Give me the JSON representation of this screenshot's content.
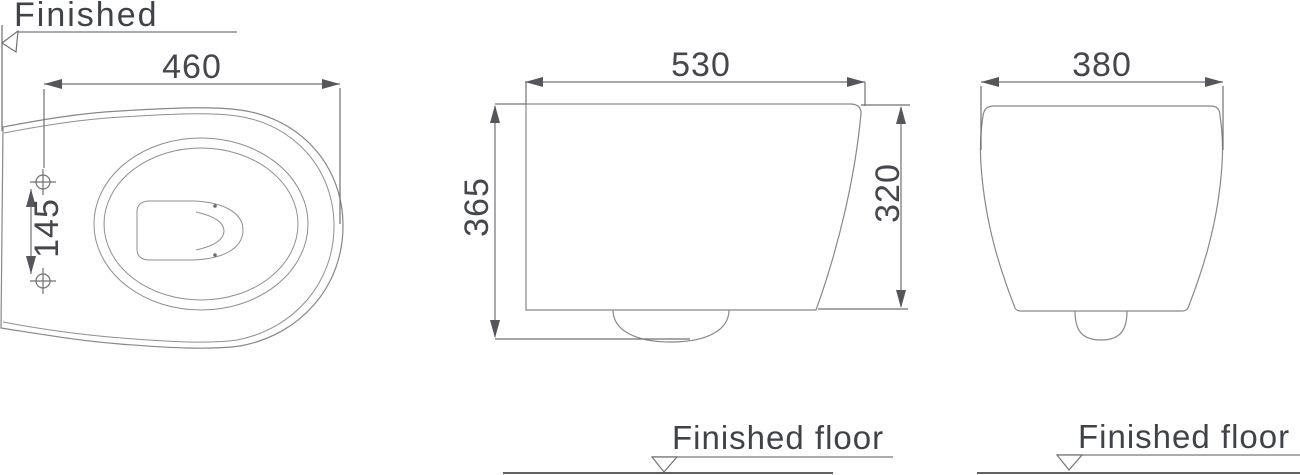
{
  "drawing": {
    "title_context": "wall-hung toilet dimension drawing",
    "labels": {
      "finished_wall": "Finished",
      "finished_floor": "Finished floor"
    },
    "dims": {
      "top_width": "460",
      "hole_spacing": "145",
      "side_depth": "530",
      "height_to_floor": "365",
      "body_height": "320",
      "front_width": "380"
    },
    "colors": {
      "background": "#ffffff",
      "outline": "#85878a",
      "dimension_line": "#6f7173",
      "arrow": "#54565a",
      "text": "#3f4247"
    }
  }
}
